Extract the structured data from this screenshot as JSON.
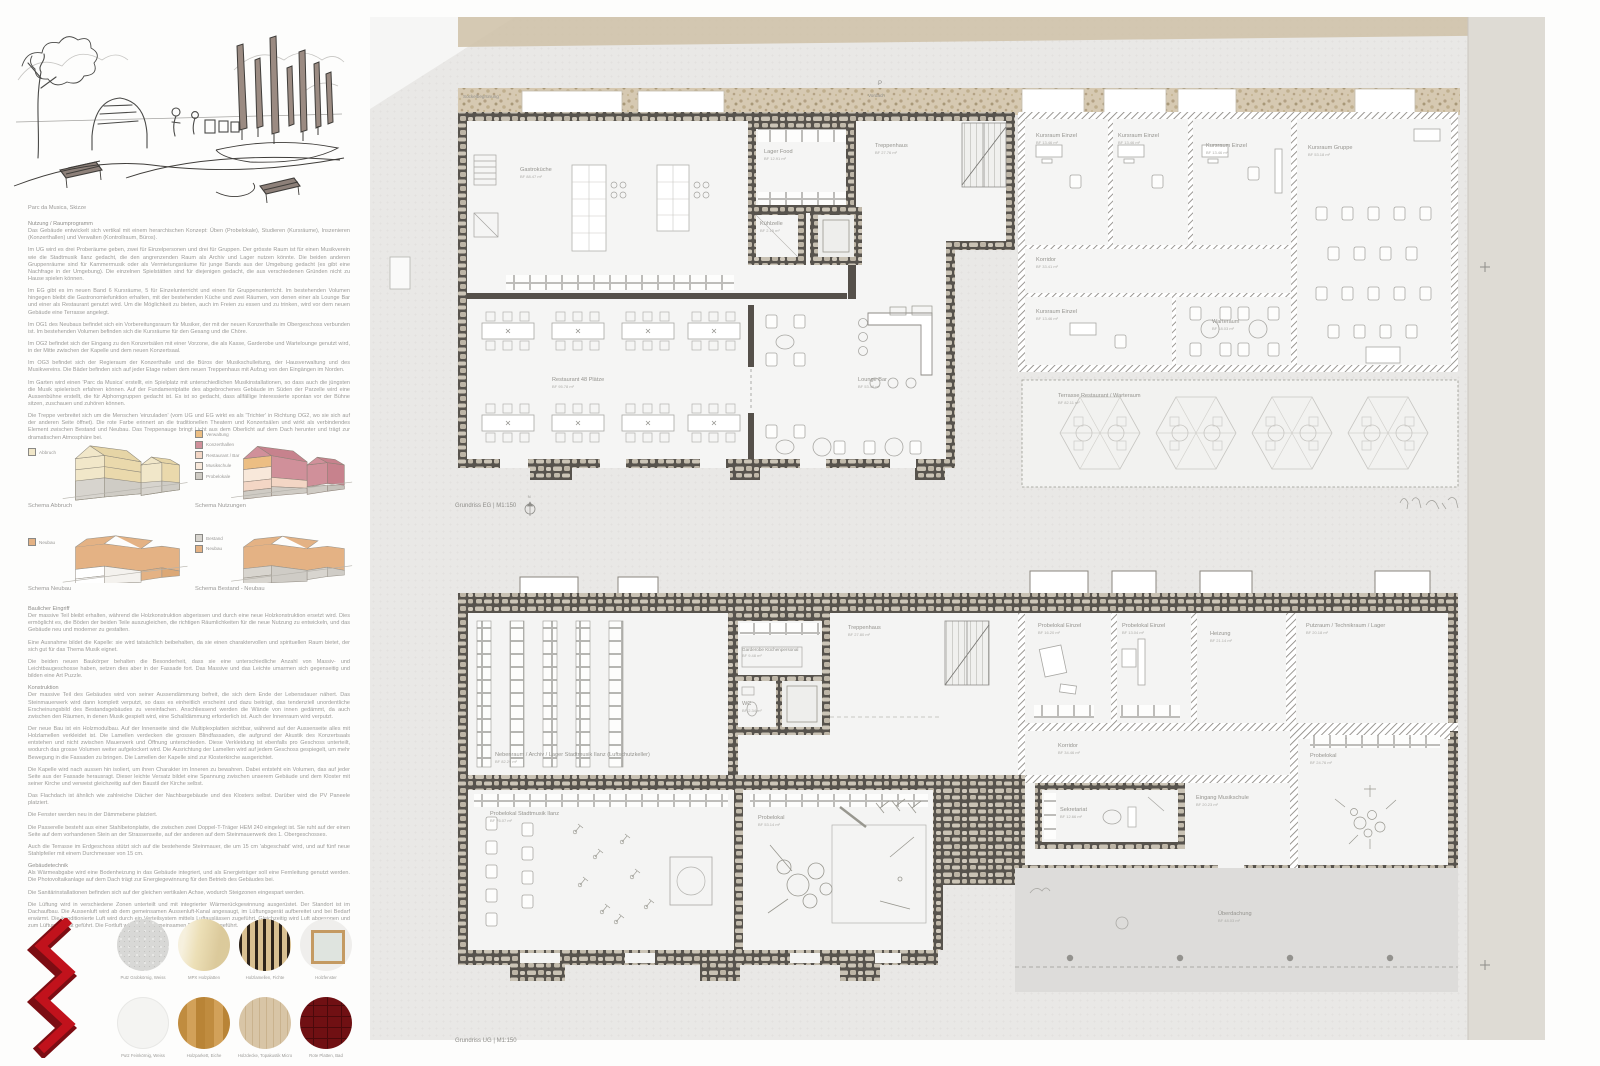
{
  "sketch": {
    "caption": "Parc da Musica, Skizze"
  },
  "sections": [
    {
      "heading": "Nutzung / Raumprogramm",
      "paragraphs": [
        "Das Gebäude entwickelt sich vertikal mit einem herarchischen Konzept: Üben (Probelokale), Studieren (Kursräume), Inszenieren (Konzerthallen) und Verwalten (Kontrollraum, Büros).",
        "Im UG wird es drei Proberäume geben, zwei für Einzelpersonen und drei für Gruppen. Der grösste Raum ist für einen Musikverein wie die Stadtmusik Ilanz gedacht, die den angrenzenden Raum als Archiv und Lager nutzen könnte. Die beiden anderen Gruppenräume sind für Kammermusik oder als Vermietungsräume für junge Bands aus der Umgebung gedacht (es gibt eine Nachfrage in der Umgebung). Die einzelnen Spielstätten sind für diejenigen gedacht, die aus verschiedenen Gründen nicht zu Hause spielen können.",
        "Im EG gibt es im neuen Band 6 Kursräume, 5 für Einzelunterricht und einen für Gruppenunterricht. Im bestehenden Volumen hingegen bleibt die Gastronomiefunktion erhalten, mit der bestehenden Küche und zwei Räumen, von denen einer als Lounge Bar und einer als Restaurant genutzt wird. Um die Möglichkeit zu bieten, auch im Freien zu essen und zu trinken, wird vor dem neuen Gebäude eine Terrasse angelegt.",
        "Im OG1 des Neubaus befindet sich ein Vorbereitungsraum für Musiker, der mit der neuen Konzerthalle im Obergeschoss verbunden ist. Im bestehenden Volumen befinden sich die Kursräume für den Gesang und die Chöre.",
        "Im OG2 befindet sich der Eingang zu den Konzertsälen mit einer Vorzone, die als Kasse, Garderobe und Wartelounge genutzt wird, in der Mitte zwischen der Kapelle und dem neuen Konzertsaal.",
        "Im OG3 befindet sich der Regieraum der Konzerthalle und die Büros der Musikschulleitung, der Hausverwaltung und des Musikvereins. Die Bäder befinden sich auf jeder Etage neben dem neuen Treppenhaus mit Aufzug von den Eingängen im Norden.",
        "Im Garten wird einen 'Parc da Musica' erstellt, ein Spielplatz mit unterschiedlichen Musikinstallationen, so dass auch die jüngsten die Musik spielerisch erfahren können. Auf der Fundamentplatte des abgebrochenes Gebäude im Süden der Parzelle wird eine Aussenbühne erstellt, die für Alphorngruppen gedacht ist. Es ist so gedacht, dass allfällige Interessierte spontan vor der Bühne sitzen, zuschauen und zuhören können.",
        "Die Treppe verbreitet sich um die Menschen 'einzuladen' (vom UG und EG wirkt es als 'Trichter' in Richtung OG2, wo sie sich auf der anderen Seite öffnet). Die rote Farbe erinnert an die traditionellen Theatern und Konzertsälen und wirkt als verbindendes Element zwischen Bestand und Neubau. Das Treppenauge bringt Licht aus dem Oberlicht auf dem Dach herunter und trägt zur dramatischen Atmosphäre bei."
      ]
    },
    {
      "heading": "Baulicher Eingriff",
      "paragraphs": [
        "Der massive Teil bleibt erhalten, während die Holzkonstruktion abgerissen und durch eine neue Holzkonstruktion ersetzt wird. Dies ermöglicht es, die Böden der beiden Teile auszugleichen, die richtigen Räumlichkeiten für die neue Nutzung zu entwickeln, und das Gebäude neu und moderner zu gestalten.",
        "Eine Ausnahme bildet die Kapelle: sie wird tatsächlich beibehalten, da sie einen charaktervollen und spirituellen Raum bietet, der sich gut für das Thema Musik eignet.",
        "Die beiden neuen Baukörper behalten die Besonderheit, dass sie eine unterschiedliche Anzahl von Massiv- und Leichtbaugeschosse haben, setzen dies aber in der Fassade fort. Das Massive und das Leichte umarmen sich gegenseitig und bilden eine Art Puzzle."
      ]
    },
    {
      "heading": "Konstruktion",
      "paragraphs": [
        "Der massive Teil des Gebäudes wird von seiner Aussendämmung befreit, die sich dem Ende der Lebensdauer nähert. Das Steinmauerwerk wird dann komplett verputzt, so dass es einheitlich erscheint und dazu beiträgt, das tendenziell unordentliche Erscheinungsbild des Bestandsgebäudes zu vereinfachen. Anschliessend werden die Wände von innen gedämmt, da auch zwischen den Räumen, in denen Musik gespielt wird, eine Schalldämmung erforderlich ist. Auch der Innenraum wird verputzt.",
        "Der neue Bau ist ein Holzmodulbau. Auf der Innenseite sind die Multiplexplatten sichtbar, während auf der Aussenseite alles mit Holzlamellen verkleidet ist. Die Lamellen verdecken die grossen Blindfassaden, die aufgrund der Akustik des Konzertsaals entstehen und nicht zwischen Mauerwerk und Öffnung unterschieden. Diese Verkleidung ist ebenfalls pro Geschoss unterteilt, wodurch das grosse Volumen weiter aufgelockert wird. Die Ausrichtung der Lamellen wird auf jedem Geschoss gespiegelt, um mehr Bewegung in die Fassaden zu bringen. Die Lamellen der Kapelle sind zur Klosterkirche ausgerichtet.",
        "Die Kapelle wird nach aussen hin isoliert, um ihren Charakter im Inneren zu bewahren. Dabei entsteht ein Volumen, das auf jeder Seite aus der Fassade herausragt. Dieser leichte Versatz bildet eine Spannung zwischen unserem Gebäude und dem Kloster mit seiner Kirche und verweist gleichzeitig auf den Baustil der Kirche selbst.",
        "Das Flachdach ist ähnlich wie zahlreiche Dächer der Nachbargebäude und des Klosters selbst. Darüber wird die PV Paneele platziert.",
        "Die Fenster werden neu in der Dämmebene platziert.",
        "Die Passerelle besteht aus einer Stahlbetonplatte, die zwischen zwei Doppel-T-Träger HEM 240 eingelegt ist. Sie ruht auf der einen Seite auf dem vorhandenen Stein an der Strassenseite, auf der anderen auf dem Steinmauerwerk des 1. Obergeschosses.",
        "Auch die Terrasse im Erdgeschoss stützt sich auf die bestehende Steinmauer, die um 15 cm 'abgeschabt' wird, und auf fünf neue Stahlpfeiler mit einem Durchmesser von 15 cm."
      ]
    },
    {
      "heading": "Gebäudetechnik",
      "paragraphs": [
        "Als Wärmeabgabe wird eine Bodenheizung in das Gebäude integriert, und als Energieträger soll eine Fernleitung genutzt werden. Die Photovoltaikanlage auf dem Dach trägt zur Energiegewinnung für den Betrieb des Gebäudes bei.",
        "Die Sanitärinstallationen befinden sich auf der gleichen vertikalen Achse, wodurch Steigzonen eingespart werden.",
        "Die Lüftung wird in verschiedene Zonen unterteilt und mit integrierter Wärmerückgewinnung ausgerüstet. Der Standort ist im Dachaufbau. Die Aussenluft wird ab dem gemeinsamen Aussenluft-Kanal angesaugt, im Lüftungsgerät aufbereitet und bei Bedarf erwärmt. Die konditionierte Luft wird durch ein Verteilsystem mittels Luftauslässen zugeführt. Gleichzeitig wird Luft abgesogen und zum Lüftungsgerät geführt. Die Fortluft wird in den gemeinsamen Fortluftkanal geführt."
      ]
    }
  ],
  "schemas": [
    {
      "caption": "Schema Abbruch",
      "legend": [
        {
          "label": "Abbruch",
          "color": "#f1e7c9"
        }
      ]
    },
    {
      "caption": "Schema Nutzungen",
      "legend": [
        {
          "label": "Verwaltung",
          "color": "#ecbe83"
        },
        {
          "label": "Konzerthallen",
          "color": "#d0909a"
        },
        {
          "label": "Restaurant / Bar",
          "color": "#f3d6c5"
        },
        {
          "label": "Musikschule",
          "color": "#f8e8da"
        },
        {
          "label": "Probelokale",
          "color": "#cfcbc4"
        }
      ]
    },
    {
      "caption": "Schema Neubau",
      "legend": [
        {
          "label": "Neubau",
          "color": "#e4b284"
        }
      ]
    },
    {
      "caption": "Schema Bestand - Neubau",
      "legend": [
        {
          "label": "Bestand",
          "color": "#d8d5cf"
        },
        {
          "label": "Neubau",
          "color": "#e4b284"
        }
      ]
    }
  ],
  "materials": [
    {
      "label": "Putz Grobkörnig, Weiss"
    },
    {
      "label": "MPX Holzplatten"
    },
    {
      "label": "Holzlamellen, Fichte"
    },
    {
      "label": "Holzfenster"
    },
    {
      "label": "Putz Feinkörnig, Weiss"
    },
    {
      "label": "Holzparkett, Eiche"
    },
    {
      "label": "Holzdecke, Topakustik Micro"
    },
    {
      "label": "Rote Platten, Bad"
    }
  ],
  "annotations": {
    "sockelbegruenung": "Sockelbegrünung",
    "p": "P",
    "vordach": "Vordach",
    "north": "N"
  },
  "plans": {
    "eg": {
      "caption": "Grundriss EG | M1:150",
      "rooms": [
        {
          "name": "Gastroküche",
          "area": "BF 88.47 m²"
        },
        {
          "name": "Lager Food",
          "area": "BF 12.91 m²"
        },
        {
          "name": "Kühlzelle",
          "area": "BF 2.15 m²"
        },
        {
          "name": "Treppenhaus",
          "area": "BF 27.76 m²"
        },
        {
          "name": "Kursraum Einzel",
          "area": "BF 13.46 m²"
        },
        {
          "name": "Kursraum Einzel",
          "area": "BF 13.46 m²"
        },
        {
          "name": "Kursraum Einzel",
          "area": "BF 13.46 m²"
        },
        {
          "name": "Kursraum Gruppe",
          "area": "BF 53.18 m²"
        },
        {
          "name": "Korridor",
          "area": "BF 33.41 m²"
        },
        {
          "name": "Kursraum Einzel",
          "area": "BF 13.46 m²"
        },
        {
          "name": "Warteraum",
          "area": "BF 18.03 m²"
        },
        {
          "name": "Restaurant 48 Plätze",
          "area": "BF 95.78 m²"
        },
        {
          "name": "Lounge Bar",
          "area": "BF 53.46 m²"
        },
        {
          "name": "Terrasse Restaurant / Warteraum",
          "area": "BF 82.11 m²"
        }
      ]
    },
    "ug": {
      "caption": "Grundriss UG | M1:150",
      "rooms": [
        {
          "name": "Nebenraum / Archiv / Lager Stadtmusik Ilanz (Luftschutzkeller)",
          "area": "BF 82.29 m²"
        },
        {
          "name": "Garderobe Küchenpersonal",
          "area": "BF 9.48 m²"
        },
        {
          "name": "WC",
          "area": "BF 2.34 m²"
        },
        {
          "name": "Treppenhaus",
          "area": "BF 27.80 m²"
        },
        {
          "name": "Probelokal Einzel",
          "area": "BF 16.20 m²"
        },
        {
          "name": "Probelokal Einzel",
          "area": "BF 13.04 m²"
        },
        {
          "name": "Heizung",
          "area": "BF 21.14 m²"
        },
        {
          "name": "Putzraum / Technikraum / Lager",
          "area": "BF 20.18 m²"
        },
        {
          "name": "Korridor",
          "area": "BF 34.46 m²"
        },
        {
          "name": "Sekretariat",
          "area": "BF 12.66 m²"
        },
        {
          "name": "Eingang Musikschule",
          "area": "BF 20.23 m²"
        },
        {
          "name": "Probelokal",
          "area": "BF 24.76 m²"
        },
        {
          "name": "Probelokal Stadtmusik Ilanz",
          "area": "BF 76.07 m²"
        },
        {
          "name": "Probelokal",
          "area": "BF 53.14 m²"
        },
        {
          "name": "Überdachung",
          "area": "BF 48.03 m²"
        }
      ]
    }
  }
}
